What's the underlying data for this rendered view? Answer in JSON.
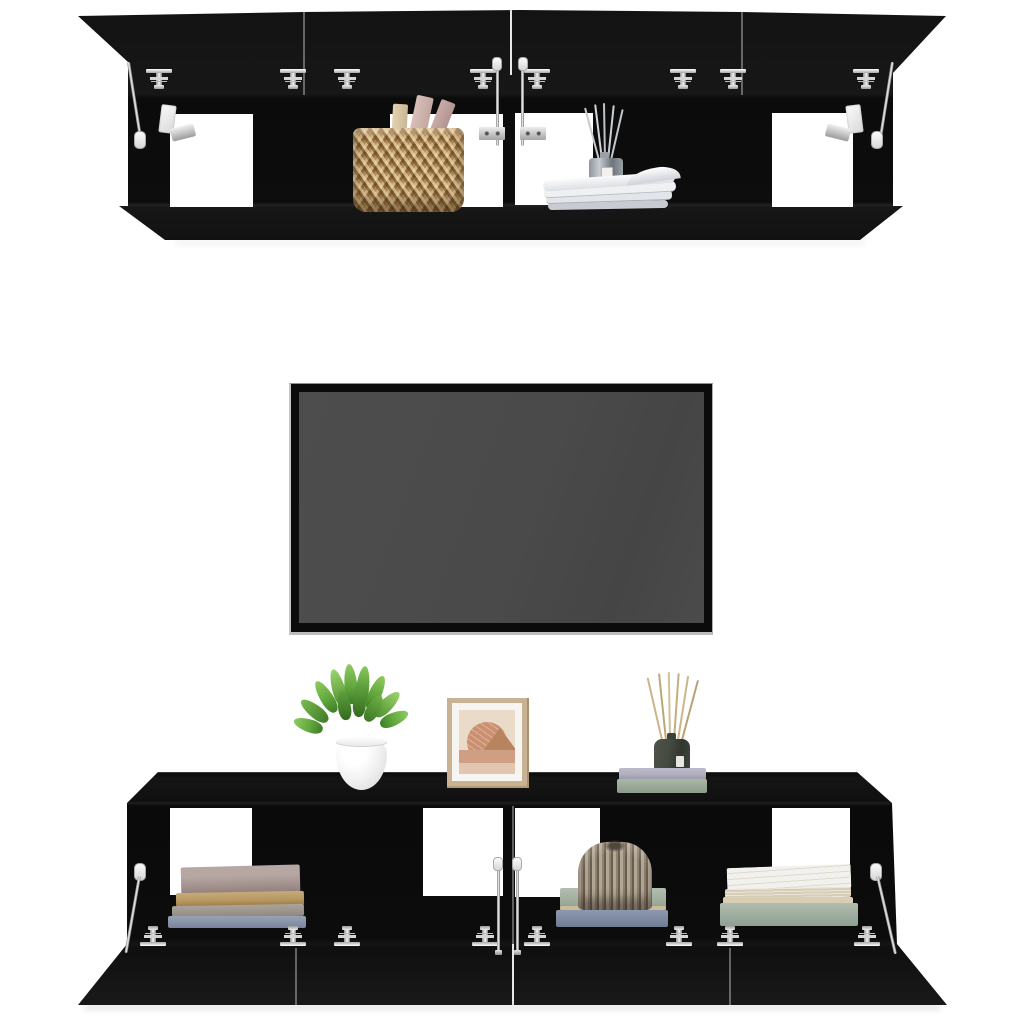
{
  "meta": {
    "type": "product-photo",
    "alt": "Four black wall-mounted TV hanging cabinets with open flap doors and chrome fittings, styled with decor items, shown around a blank flat-screen TV on a white background"
  },
  "colors": {
    "background": "#ffffff",
    "cabinet-black": "#0d0d0d",
    "cabinet-sheen": "#1b1b1b",
    "hardware-chrome": "#d9d9d9",
    "strut-cap-white": "#fafafa",
    "tv-frame-black": "#0b0b0b",
    "tv-screen-gray": "#4a4a4a",
    "tv-edge-silver": "#c6c6c6",
    "basket-tan": "#b28c57",
    "plant-green": "#63a83e",
    "pot-white": "#ffffff",
    "frame-wood-tan": "#c9b294",
    "art-beige": "#eadbc9",
    "art-salmon": "#cb9070",
    "art-dusty-pink": "#cf9f85",
    "ornament-taupe": "#a39685",
    "diffuser-bottle-green": "#454b41",
    "reed-stick-tan": "#cbb68b",
    "book-mauve": "#a5918d",
    "book-camel": "#b6975f",
    "book-slate-blue": "#8691a6",
    "book-sage-green": "#9fae9d",
    "book-lavender-gray": "#b3b1c0",
    "book-white": "#f2f1ed",
    "magazine-white": "#eef0f2",
    "magazine-blue": "#4a5672"
  },
  "scene": {
    "upper_cabinets": {
      "label": "Two wall-mounted TV cabinets with flap doors open upward",
      "finish": "black",
      "hardware": [
        "chrome flap hinges",
        "gas lift struts with white end caps",
        "chrome wall-mount rails",
        "white stay brackets"
      ],
      "compartments": [
        {
          "position": 1,
          "contents": "empty, open back showing white wall"
        },
        {
          "position": 2,
          "contents": "woven seagrass basket holding books"
        },
        {
          "position": 3,
          "contents": "glass reed diffuser behind a fanned stack of magazines"
        },
        {
          "position": 4,
          "contents": "empty, open back showing white wall"
        }
      ]
    },
    "tv": {
      "label": "Flat-screen TV, switched off",
      "screen": "blank dark gray"
    },
    "lower_cabinets": {
      "label": "Two wall-mounted TV cabinets with flap doors open downward",
      "finish": "black",
      "hardware": [
        "chrome flap hinges",
        "gas lift struts with white end caps"
      ],
      "top_items": [
        "green houseplant in a round white pot",
        "framed abstract landscape print in a light wood frame",
        "dark green reed diffuser on two stacked books"
      ],
      "compartments": [
        {
          "position": 1,
          "contents": "stack of four hardcover books in mauve, camel, gray and slate blue"
        },
        {
          "position": 2,
          "contents": "empty"
        },
        {
          "position": 3,
          "contents": "pleated paper ornament on sage and slate books"
        },
        {
          "position": 4,
          "contents": "white open-paged book on cream and sage green books"
        }
      ]
    }
  }
}
